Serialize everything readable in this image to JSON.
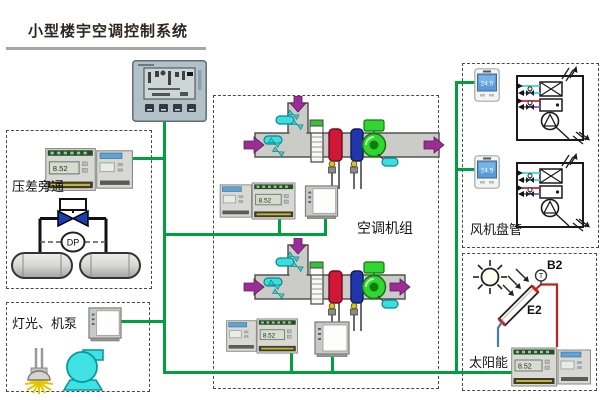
{
  "page": {
    "title": "小型楼宇空调控制系统"
  },
  "sections": {
    "bypass": {
      "label": "压差旁通",
      "dp_sensor": "DP"
    },
    "lighting": {
      "label": "灯光、机泵"
    },
    "ahu": {
      "label": "空调机组"
    },
    "fancoil": {
      "label": "风机盘管",
      "thermostat1_reading": "24.5",
      "thermostat2_reading": "24.5"
    },
    "solar": {
      "label": "太阳能",
      "sensor_tag": "B2",
      "collector_tag": "E2",
      "sensor_symbol": "T"
    }
  },
  "devices": {
    "ddc_lcd_reading": "8.52"
  },
  "colors": {
    "bus_wire": "#00A040",
    "hot_coil": "#D21637",
    "cold_coil": "#2136AA",
    "air_arrow": "#9B2D96",
    "sensor_cyan": "#3ADEDE",
    "solar_supply_pipe": "#BB2222",
    "solar_return_pipe": "#4A7AA8",
    "pump": "#3EE2E2",
    "lamp_glow": "#FFD800"
  }
}
